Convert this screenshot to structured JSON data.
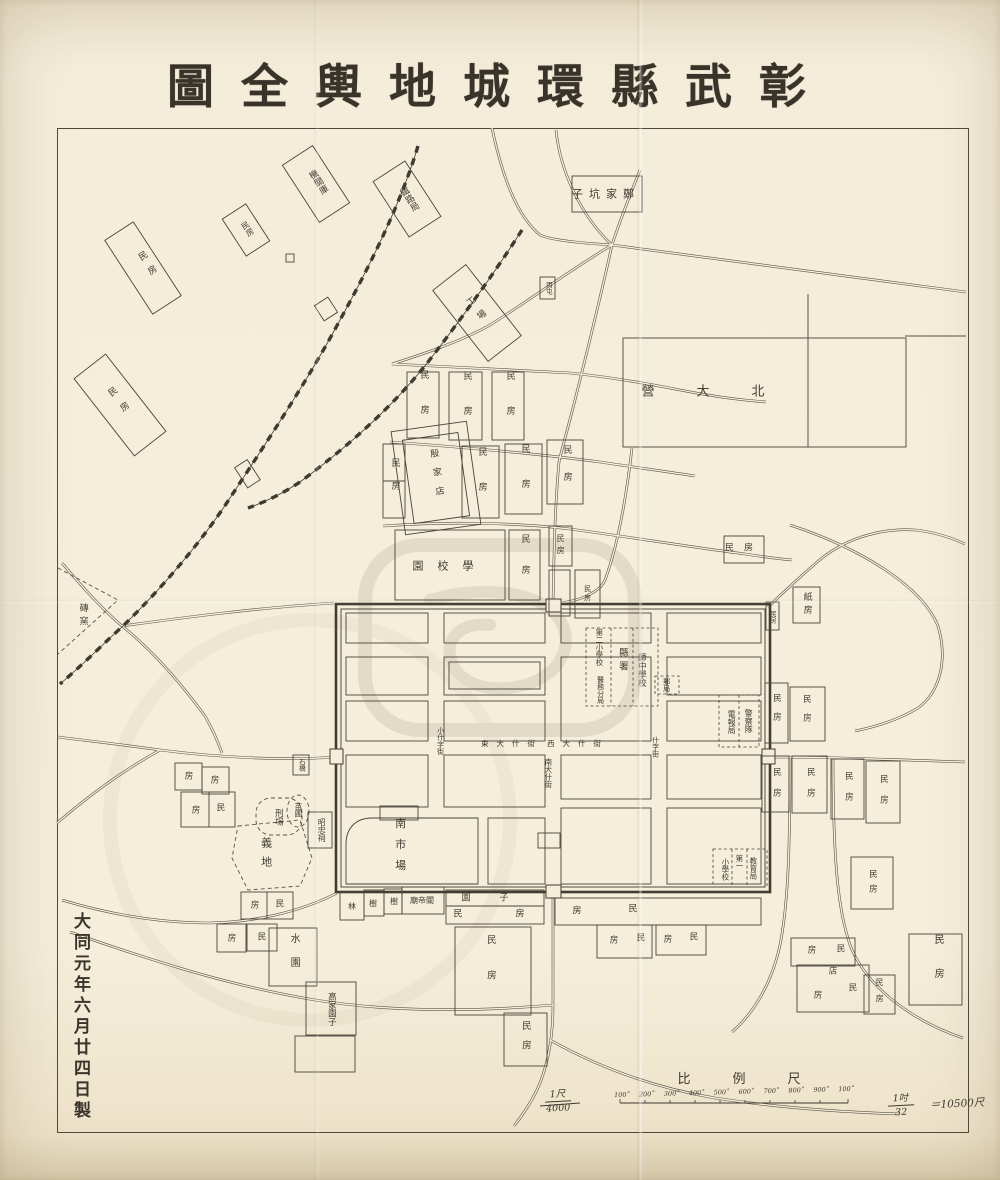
{
  "title": {
    "text": "圖全輿地城環縣武彰",
    "reading_rtl": "彰武縣環城地輿全圖"
  },
  "colophon": {
    "text": "大同元年六月廿四日製"
  },
  "scale": {
    "heading": "比例尺",
    "left_fraction_num": "1尺",
    "left_fraction_den": "4000",
    "bar_ticks": [
      "100˚",
      "200˚",
      "300˚",
      "400˚",
      "500˚",
      "600˚",
      "700˚",
      "800˚",
      "900˚",
      "100˚"
    ],
    "right_fraction_num": "1吋",
    "right_fraction_den": "32",
    "right_equals": "＝10500尺"
  },
  "map": {
    "labels": [
      {
        "t": "鐵路局",
        "x": 408,
        "y": 200,
        "m": "v",
        "s": 9,
        "r": -33
      },
      {
        "t": "機關庫",
        "x": 317,
        "y": 183,
        "m": "v",
        "s": 9,
        "r": -33
      },
      {
        "t": "民房",
        "x": 247,
        "y": 229,
        "m": "v",
        "s": 8,
        "r": -33
      },
      {
        "t": "民房",
        "x": 148,
        "y": 267,
        "m": "v",
        "s": 9,
        "r": -33,
        "ls": 8
      },
      {
        "t": "民房",
        "x": 120,
        "y": 404,
        "m": "v",
        "s": 9,
        "r": -38,
        "ls": 10
      },
      {
        "t": "工場",
        "x": 477,
        "y": 312,
        "m": "v",
        "s": 9,
        "r": -38,
        "ls": 8
      },
      {
        "t": "殷家店",
        "x": 436,
        "y": 477,
        "m": "v",
        "s": 9,
        "r": -8,
        "ls": 10
      },
      {
        "t": "子坑家鄭",
        "x": 606,
        "y": 194,
        "m": "h",
        "s": 11,
        "ls": 6
      },
      {
        "t": "丙屯",
        "x": 548,
        "y": 288,
        "m": "v",
        "s": 6.5
      },
      {
        "t": "營大北",
        "x": 724,
        "y": 392,
        "m": "h",
        "s": 13,
        "ls": 42
      },
      {
        "t": "民房",
        "x": 423,
        "y": 405,
        "m": "v",
        "s": 9,
        "ls": 26
      },
      {
        "t": "民房",
        "x": 466,
        "y": 406,
        "m": "v",
        "s": 9,
        "ls": 26
      },
      {
        "t": "民房",
        "x": 509,
        "y": 406,
        "m": "v",
        "s": 9,
        "ls": 26
      },
      {
        "t": "民房",
        "x": 394,
        "y": 481,
        "m": "v",
        "s": 9,
        "ls": 14
      },
      {
        "t": "民房",
        "x": 481,
        "y": 482,
        "m": "v",
        "s": 9,
        "ls": 26
      },
      {
        "t": "民房",
        "x": 524,
        "y": 479,
        "m": "v",
        "s": 9,
        "ls": 26
      },
      {
        "t": "民房",
        "x": 566,
        "y": 472,
        "m": "v",
        "s": 9,
        "ls": 18
      },
      {
        "t": "園校學",
        "x": 450,
        "y": 566,
        "m": "h",
        "s": 11,
        "ls": 14
      },
      {
        "t": "民房",
        "x": 524,
        "y": 565,
        "m": "v",
        "s": 9,
        "ls": 22
      },
      {
        "t": "民房",
        "x": 560,
        "y": 546,
        "m": "v",
        "s": 8,
        "ls": 4
      },
      {
        "t": "民房",
        "x": 587,
        "y": 594,
        "m": "v",
        "s": 7,
        "ls": 2
      },
      {
        "t": "民房",
        "x": 744,
        "y": 549,
        "m": "h",
        "s": 9,
        "ls": 10
      },
      {
        "t": "紙房",
        "x": 806,
        "y": 605,
        "m": "v",
        "s": 9,
        "ls": 4
      },
      {
        "t": "民房",
        "x": 772,
        "y": 617,
        "m": "v",
        "s": 6.5
      },
      {
        "t": "第二小學校",
        "x": 599,
        "y": 647,
        "m": "v",
        "s": 7.5
      },
      {
        "t": "縣署",
        "x": 622,
        "y": 661,
        "m": "v",
        "s": 9.5,
        "ls": 4
      },
      {
        "t": "師中學校",
        "x": 641,
        "y": 670,
        "m": "v",
        "s": 8.5
      },
      {
        "t": "醫務分局",
        "x": 600,
        "y": 690,
        "m": "v",
        "s": 7
      },
      {
        "t": "郵局",
        "x": 666,
        "y": 685,
        "m": "v",
        "s": 7
      },
      {
        "t": "警察隊",
        "x": 748,
        "y": 721,
        "m": "v",
        "s": 8
      },
      {
        "t": "電報局",
        "x": 731,
        "y": 722,
        "m": "v",
        "s": 8
      },
      {
        "t": "教育局",
        "x": 753,
        "y": 868,
        "m": "v",
        "s": 7.5
      },
      {
        "t": "第一",
        "x": 739,
        "y": 862,
        "m": "v",
        "s": 7.5
      },
      {
        "t": "小學校",
        "x": 725,
        "y": 869,
        "m": "v",
        "s": 7.5
      },
      {
        "t": "東大什街",
        "x": 512,
        "y": 744,
        "m": "h",
        "s": 7.5,
        "ls": 8
      },
      {
        "t": "西大什街",
        "x": 578,
        "y": 744,
        "m": "h",
        "s": 7.5,
        "ls": 8
      },
      {
        "t": "小什字街",
        "x": 440,
        "y": 741,
        "m": "v",
        "s": 7
      },
      {
        "t": "南大什街",
        "x": 548,
        "y": 773,
        "m": "v",
        "s": 7.5
      },
      {
        "t": "什字街",
        "x": 655,
        "y": 747,
        "m": "v",
        "s": 7
      },
      {
        "t": "南市場",
        "x": 400,
        "y": 849,
        "m": "v",
        "s": 11,
        "ls": 10
      },
      {
        "t": "昭忠祠",
        "x": 321,
        "y": 830,
        "m": "v",
        "s": 8
      },
      {
        "t": "苗圃",
        "x": 298,
        "y": 810,
        "m": "v",
        "s": 7.5
      },
      {
        "t": "刑場",
        "x": 278,
        "y": 817,
        "m": "v",
        "s": 8.5
      },
      {
        "t": "義地",
        "x": 266,
        "y": 856,
        "m": "v",
        "s": 11,
        "ls": 8
      },
      {
        "t": "磚窯",
        "x": 82,
        "y": 616,
        "m": "v",
        "s": 9,
        "ls": 4
      },
      {
        "t": "石橋",
        "x": 301,
        "y": 765,
        "m": "v",
        "s": 6.5
      },
      {
        "t": "房",
        "x": 189,
        "y": 777,
        "m": "h",
        "s": 8.5
      },
      {
        "t": "房",
        "x": 215,
        "y": 781,
        "m": "h",
        "s": 8.5
      },
      {
        "t": "民",
        "x": 221,
        "y": 809,
        "m": "h",
        "s": 8.5
      },
      {
        "t": "房",
        "x": 196,
        "y": 811,
        "m": "h",
        "s": 8.5
      },
      {
        "t": "房",
        "x": 255,
        "y": 906,
        "m": "h",
        "s": 8.5
      },
      {
        "t": "民",
        "x": 280,
        "y": 905,
        "m": "h",
        "s": 8.5
      },
      {
        "t": "房",
        "x": 232,
        "y": 939,
        "m": "h",
        "s": 8.5
      },
      {
        "t": "民",
        "x": 262,
        "y": 938,
        "m": "h",
        "s": 8.5
      },
      {
        "t": "水園",
        "x": 293,
        "y": 957,
        "m": "v",
        "s": 10,
        "ls": 14
      },
      {
        "t": "高家園子",
        "x": 331,
        "y": 1009,
        "m": "v",
        "s": 8.5
      },
      {
        "t": "林",
        "x": 352,
        "y": 907,
        "m": "h",
        "s": 8
      },
      {
        "t": "樹",
        "x": 373,
        "y": 904,
        "m": "h",
        "s": 8
      },
      {
        "t": "樹",
        "x": 394,
        "y": 902,
        "m": "h",
        "s": 8
      },
      {
        "t": "廟帝關",
        "x": 422,
        "y": 901,
        "m": "h",
        "s": 8
      },
      {
        "t": "園",
        "x": 466,
        "y": 899,
        "m": "h",
        "s": 9
      },
      {
        "t": "子",
        "x": 504,
        "y": 899,
        "m": "h",
        "s": 9
      },
      {
        "t": "民",
        "x": 458,
        "y": 915,
        "m": "h",
        "s": 9
      },
      {
        "t": "房",
        "x": 520,
        "y": 915,
        "m": "h",
        "s": 9
      },
      {
        "t": "房",
        "x": 577,
        "y": 912,
        "m": "h",
        "s": 9
      },
      {
        "t": "民",
        "x": 633,
        "y": 910,
        "m": "h",
        "s": 9
      },
      {
        "t": "民房",
        "x": 490,
        "y": 970,
        "m": "v",
        "s": 9.5,
        "ls": 26
      },
      {
        "t": "房",
        "x": 614,
        "y": 941,
        "m": "h",
        "s": 8.5
      },
      {
        "t": "民",
        "x": 641,
        "y": 939,
        "m": "h",
        "s": 8.5
      },
      {
        "t": "房",
        "x": 668,
        "y": 940,
        "m": "h",
        "s": 8.5
      },
      {
        "t": "民",
        "x": 694,
        "y": 938,
        "m": "h",
        "s": 8.5
      },
      {
        "t": "民房",
        "x": 872,
        "y": 884,
        "m": "v",
        "s": 8.5,
        "ls": 6
      },
      {
        "t": "房",
        "x": 812,
        "y": 951,
        "m": "h",
        "s": 8.5
      },
      {
        "t": "民",
        "x": 841,
        "y": 950,
        "m": "h",
        "s": 8.5
      },
      {
        "t": "店",
        "x": 833,
        "y": 972,
        "m": "h",
        "s": 8.5
      },
      {
        "t": "民",
        "x": 853,
        "y": 989,
        "m": "h",
        "s": 8.5
      },
      {
        "t": "房",
        "x": 818,
        "y": 996,
        "m": "h",
        "s": 8.5
      },
      {
        "t": "民房",
        "x": 879,
        "y": 994,
        "m": "v",
        "s": 8,
        "ls": 8
      },
      {
        "t": "民房",
        "x": 937,
        "y": 968,
        "m": "v",
        "s": 10,
        "ls": 24
      },
      {
        "t": "民房",
        "x": 525,
        "y": 1040,
        "m": "v",
        "s": 9.5,
        "ls": 10
      },
      {
        "t": "民房",
        "x": 776,
        "y": 712,
        "m": "v",
        "s": 8.5,
        "ls": 10
      },
      {
        "t": "民房",
        "x": 806,
        "y": 713,
        "m": "v",
        "s": 8.5,
        "ls": 10
      },
      {
        "t": "民房",
        "x": 776,
        "y": 788,
        "m": "v",
        "s": 8.5,
        "ls": 12
      },
      {
        "t": "民房",
        "x": 810,
        "y": 788,
        "m": "v",
        "s": 8.5,
        "ls": 12
      },
      {
        "t": "民房",
        "x": 848,
        "y": 792,
        "m": "v",
        "s": 8.5,
        "ls": 12
      },
      {
        "t": "民房",
        "x": 883,
        "y": 795,
        "m": "v",
        "s": 8.5,
        "ls": 12
      }
    ]
  }
}
